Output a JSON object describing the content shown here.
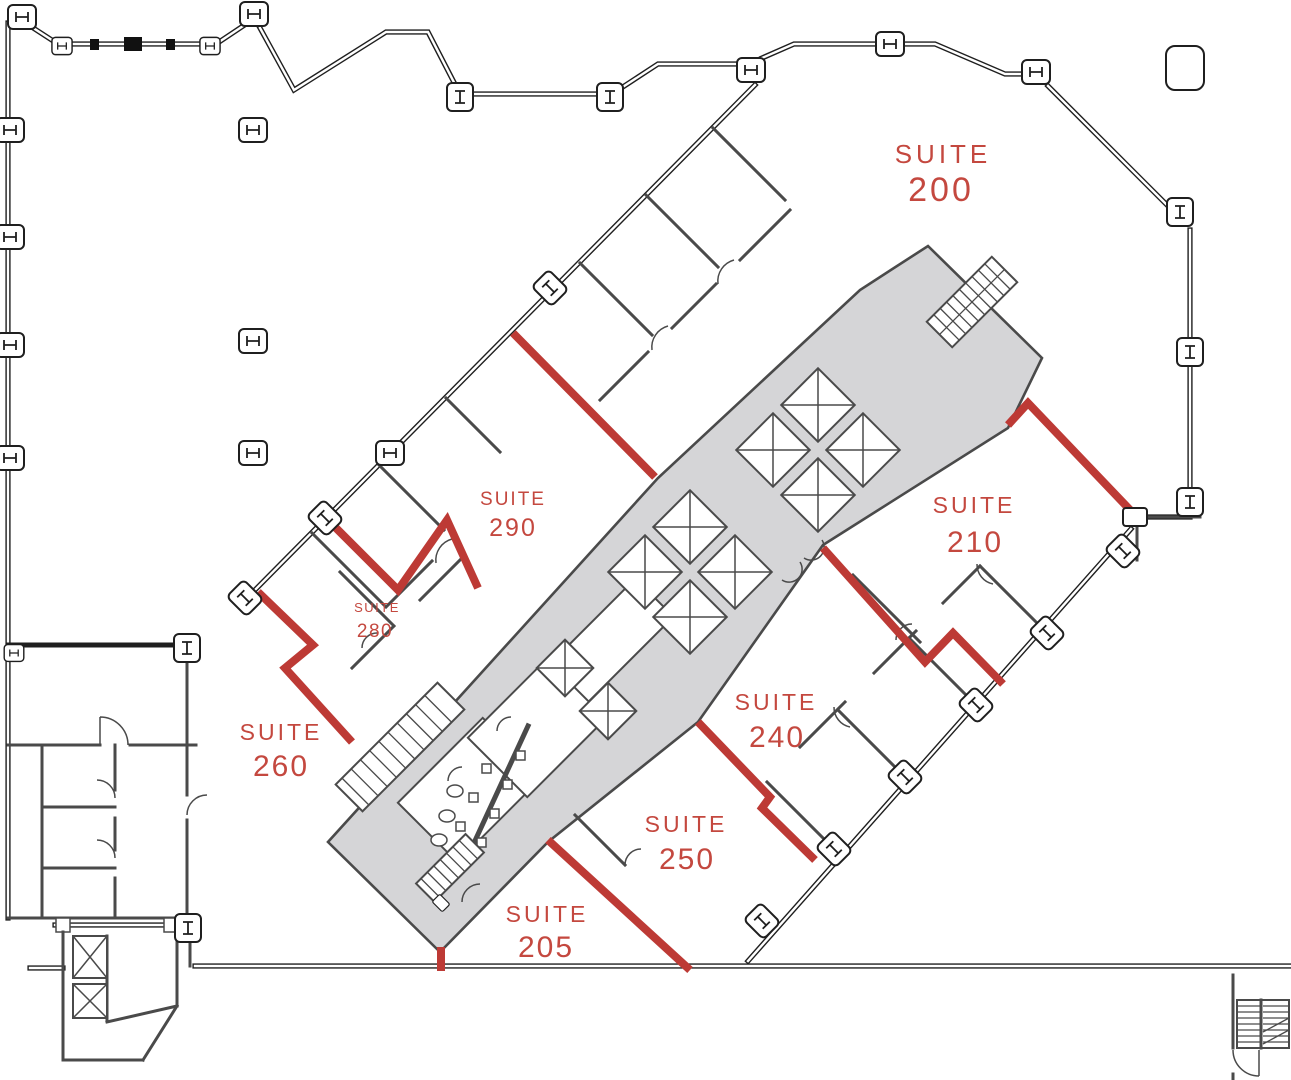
{
  "document": {
    "kind": "office-floor-plan"
  },
  "colors": {
    "demising_wall": "#BD3A35",
    "suite_label": "#C4483F",
    "core_fill": "#D5D5D7",
    "partition_wall": "#4A4A4A",
    "exterior_wall": "#1F1F1F"
  },
  "suites": [
    {
      "id": "200",
      "word": "SUITE",
      "number": "200"
    },
    {
      "id": "290",
      "word": "SUITE",
      "number": "290"
    },
    {
      "id": "280",
      "word": "SUITE",
      "number": "280"
    },
    {
      "id": "260",
      "word": "SUITE",
      "number": "260"
    },
    {
      "id": "210",
      "word": "SUITE",
      "number": "210"
    },
    {
      "id": "240",
      "word": "SUITE",
      "number": "240"
    },
    {
      "id": "250",
      "word": "SUITE",
      "number": "250"
    },
    {
      "id": "205",
      "word": "SUITE",
      "number": "205"
    }
  ],
  "icons": {
    "column_marker": "i-beam-column-icon",
    "elevator": "elevator-x-shaft-icon",
    "stairs": "stair-treads-icon",
    "door": "door-swing-arc-icon"
  }
}
